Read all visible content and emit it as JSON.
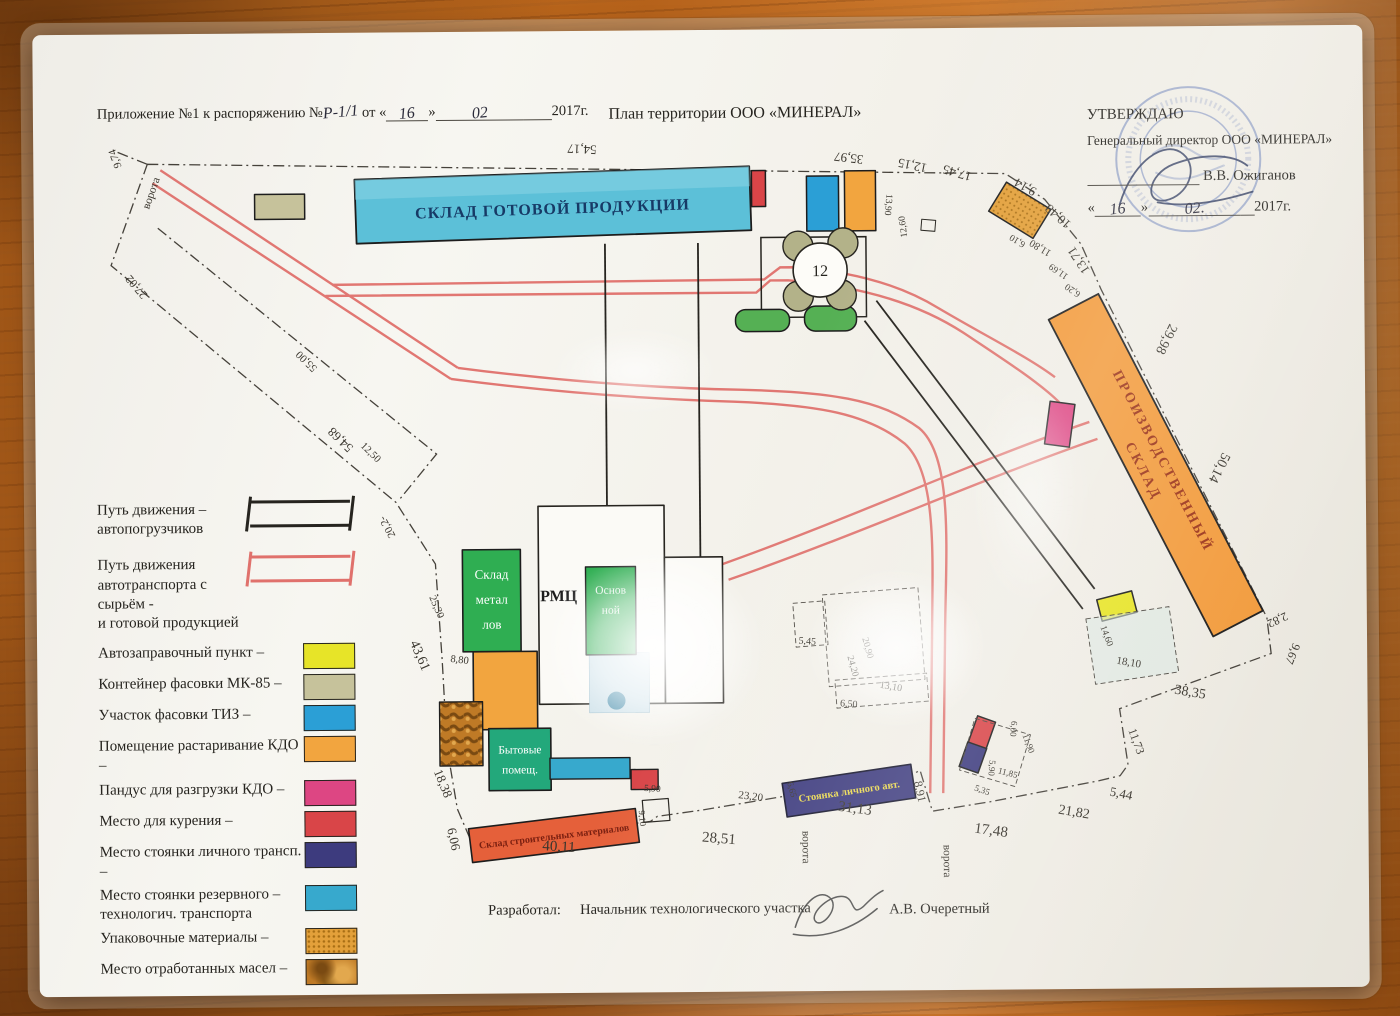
{
  "header": {
    "annex_prefix": "Приложение №1 к распоряжению №",
    "annex_number": "Р-1/1",
    "annex_ot": "от «",
    "annex_day": "16",
    "annex_close": "»",
    "annex_month": "02",
    "annex_year": "2017г.",
    "title": "План территории ООО «МИНЕРАЛ»"
  },
  "approval": {
    "approve_label": "УТВЕРЖДАЮ",
    "director_line": "Генеральный директор ООО «МИНЕРАЛ»",
    "director_name": "В.В. Ожиганов",
    "quote_open": "«",
    "date_day": "16",
    "quote_close": "»",
    "date_month": "02.",
    "date_year": "2017г."
  },
  "footer": {
    "developed_label": "Разработал:",
    "developer_title": "Начальник технологического участка",
    "developer_name": "А.В. Очеретный"
  },
  "legend": {
    "items": [
      {
        "symbol": "path",
        "color": "#26241f",
        "lines": [
          "Путь движения  –",
          "автопогрузчиков"
        ]
      },
      {
        "symbol": "path",
        "color": "#e0716c",
        "lines": [
          "Путь движения",
          "автотранспорта с сырьём -",
          "и готовой продукцией"
        ]
      },
      {
        "symbol": "swatch",
        "color": "#e7e428",
        "lines": [
          "Автозаправочный пункт –"
        ]
      },
      {
        "symbol": "swatch",
        "color": "#c6c29b",
        "lines": [
          "Контейнер фасовки МК-85 –"
        ]
      },
      {
        "symbol": "swatch",
        "color": "#2b9fd6",
        "lines": [
          "Участок фасовки ТИЗ –"
        ]
      },
      {
        "symbol": "swatch",
        "color": "#f2a53f",
        "lines": [
          "Помещение растаривание КДО –"
        ]
      },
      {
        "symbol": "swatch",
        "color": "#dd4683",
        "lines": [
          "Пандус для разгрузки КДО –"
        ]
      },
      {
        "symbol": "swatch",
        "color": "#d94548",
        "lines": [
          "Место для курения –"
        ]
      },
      {
        "symbol": "swatch",
        "color": "#3d3b7e",
        "lines": [
          "Место стоянки личного трансп. –"
        ]
      },
      {
        "symbol": "swatch",
        "color": "#37a9cd",
        "lines": [
          "Место стоянки резервного –",
          "технологич. транспорта"
        ]
      },
      {
        "symbol": "swatch",
        "color": "#e3a03a",
        "texture": "dots",
        "lines": [
          "Упаковочные материалы –"
        ]
      },
      {
        "symbol": "swatch",
        "color": "#bf7a26",
        "texture": "oil",
        "lines": [
          "Место отработанных масел –"
        ]
      }
    ]
  },
  "plan": {
    "labels": {
      "sklad_gp": "СКЛАД ГОТОВОЙ ПРОДУКЦИИ",
      "proizv_line1": "ПРОИЗВОДСТВЕННЫЙ",
      "proizv_line2": "СКЛАД",
      "metal_line1": "Склад",
      "metal_line2": "метал",
      "metal_line3": "лов",
      "rmc": "РМЦ",
      "osnov_line1": "Основ",
      "osnov_line2": "ной",
      "byt_line1": "Бытовые",
      "byt_line2": "помещ.",
      "stroit": "Склад строительных материалов",
      "stoyanka": "Стоянка личного авт.",
      "tank_number": "12"
    },
    "dims": [
      {
        "t": "54,17",
        "x": 585,
        "y": 144,
        "r": 183
      },
      {
        "t": "35,97",
        "x": 852,
        "y": 155,
        "r": 187
      },
      {
        "t": "12,15",
        "x": 916,
        "y": 163,
        "r": 192
      },
      {
        "t": "17,45",
        "x": 961,
        "y": 171,
        "r": 197
      },
      {
        "t": "9,14",
        "x": 1030,
        "y": 186,
        "r": 210
      },
      {
        "t": "10,48",
        "x": 1063,
        "y": 216,
        "r": 222
      },
      {
        "t": "13,71",
        "x": 1084,
        "y": 261,
        "r": 237
      },
      {
        "t": "13,90",
        "x": 888,
        "y": 206,
        "r": 95,
        "s": 9.5
      },
      {
        "t": "12,60",
        "x": 908,
        "y": 228,
        "r": 263,
        "s": 9.5
      },
      {
        "t": "6,10",
        "x": 1021,
        "y": 241,
        "r": 212,
        "s": 9.5
      },
      {
        "t": "11,80",
        "x": 1044,
        "y": 248,
        "r": 212,
        "s": 10.5
      },
      {
        "t": "11,69",
        "x": 1062,
        "y": 272,
        "r": 215,
        "s": 9.5
      },
      {
        "t": "6,20",
        "x": 1076,
        "y": 291,
        "r": 215,
        "s": 9.5
      },
      {
        "t": "29,98",
        "x": 1164,
        "y": 341,
        "r": 117,
        "s": 14
      },
      {
        "t": "50,14",
        "x": 1216,
        "y": 470,
        "r": 117,
        "s": 14
      },
      {
        "t": "2,82",
        "x": 1275,
        "y": 621,
        "r": 155,
        "s": 12
      },
      {
        "t": "9,67",
        "x": 1288,
        "y": 657,
        "r": 113,
        "s": 12
      },
      {
        "t": "38,35",
        "x": 1188,
        "y": 700,
        "r": 10,
        "s": 14
      },
      {
        "t": "11,73",
        "x": 1131,
        "y": 746,
        "r": 70,
        "s": 12
      },
      {
        "t": "5,44",
        "x": 1118,
        "y": 801,
        "r": 12,
        "s": 13
      },
      {
        "t": "21,82",
        "x": 1071,
        "y": 819,
        "r": 10,
        "s": 14
      },
      {
        "t": "17,48",
        "x": 988,
        "y": 837,
        "r": 8,
        "s": 15
      },
      {
        "t": "8,91",
        "x": 914,
        "y": 794,
        "r": 78,
        "s": 12
      },
      {
        "t": "31,13",
        "x": 852,
        "y": 814,
        "r": 8,
        "s": 15
      },
      {
        "t": "6,65",
        "x": 787,
        "y": 791,
        "r": 75,
        "s": 9
      },
      {
        "t": "23,20",
        "x": 748,
        "y": 800,
        "r": 8,
        "s": 11
      },
      {
        "t": "28,51",
        "x": 716,
        "y": 843,
        "r": 5,
        "s": 15
      },
      {
        "t": "5,90",
        "x": 650,
        "y": 791,
        "r": 4,
        "s": 9.5
      },
      {
        "t": "9,10",
        "x": 637,
        "y": 818,
        "r": 85,
        "s": 9
      },
      {
        "t": "40,11",
        "x": 556,
        "y": 850,
        "r": 4,
        "s": 15
      },
      {
        "t": "6,06",
        "x": 447,
        "y": 838,
        "r": 78,
        "s": 13
      },
      {
        "t": "18,38",
        "x": 437,
        "y": 783,
        "r": 68,
        "s": 13
      },
      {
        "t": "8,80",
        "x": 458,
        "y": 661,
        "r": 8,
        "s": 10.5
      },
      {
        "t": "25,30",
        "x": 433,
        "y": 606,
        "r": 67,
        "s": 10.5
      },
      {
        "t": "43,61",
        "x": 415,
        "y": 655,
        "r": 67,
        "s": 14
      },
      {
        "t": "20,2-",
        "x": 390,
        "y": 523,
        "r": 242,
        "s": 11
      },
      {
        "t": "12,50",
        "x": 369,
        "y": 452,
        "r": 45,
        "s": 10.5
      },
      {
        "t": "54,68",
        "x": 344,
        "y": 434,
        "r": 225,
        "s": 13
      },
      {
        "t": "55,00",
        "x": 310,
        "y": 356,
        "r": 225,
        "s": 11
      },
      {
        "t": "27,02",
        "x": 141,
        "y": 280,
        "r": 230,
        "s": 12
      },
      {
        "t": "9,74",
        "x": 121,
        "y": 153,
        "r": 250,
        "s": 11
      },
      {
        "t": "14,60",
        "x": 1103,
        "y": 640,
        "r": 70,
        "s": 9.5
      },
      {
        "t": "18,10",
        "x": 1127,
        "y": 669,
        "r": 10,
        "s": 11
      },
      {
        "t": "5,45",
        "x": 806,
        "y": 645,
        "r": 5,
        "s": 10
      },
      {
        "t": "24,20",
        "x": 849,
        "y": 668,
        "r": 75,
        "s": 9.5
      },
      {
        "t": "20,90",
        "x": 864,
        "y": 650,
        "r": 75,
        "s": 9.5
      },
      {
        "t": "13,10",
        "x": 889,
        "y": 691,
        "r": 10,
        "s": 10
      },
      {
        "t": "6,50",
        "x": 847,
        "y": 708,
        "r": 5,
        "s": 10
      },
      {
        "t": "6,00",
        "x": 1009,
        "y": 731,
        "r": 95,
        "s": 9
      },
      {
        "t": "11,90",
        "x": 1024,
        "y": 747,
        "r": 70,
        "s": 9
      },
      {
        "t": "5,90",
        "x": 987,
        "y": 770,
        "r": 95,
        "s": 9
      },
      {
        "t": "11,85",
        "x": 1005,
        "y": 778,
        "r": 15,
        "s": 9
      },
      {
        "t": "5,35",
        "x": 979,
        "y": 795,
        "r": 20,
        "s": 9
      }
    ],
    "gates": [
      {
        "t": "ворота",
        "x": 157,
        "y": 190,
        "r": -70,
        "s": 11.5
      },
      {
        "t": "ворота",
        "x": 800,
        "y": 848,
        "r": 90,
        "s": 11.5
      },
      {
        "t": "ворота",
        "x": 941,
        "y": 863,
        "r": 90,
        "s": 11.5
      }
    ]
  },
  "colors": {
    "ink": "#26241f",
    "dimension_ink": "#3a362e",
    "red_route": "#e0716c",
    "warehouse_blue": "#5cc0d8",
    "production_orange": "#f29b3c",
    "building_green": "#2fae52",
    "byt_teal": "#23a87b",
    "parking_navy": "#3d3b7e",
    "stroit_red": "#e5603a",
    "fuel_yellow": "#e7e428",
    "container_khaki": "#c6c29b",
    "tiz_blue": "#2b9fd6",
    "kdo_orange": "#f2a53f",
    "ramp_pink": "#dd4683",
    "smoking_red": "#d94548",
    "reserve_blue": "#37a9cd",
    "pack_orange": "#e3a03a",
    "oil_brown": "#bf7a26",
    "stamp_blue": "#5a73b4"
  }
}
